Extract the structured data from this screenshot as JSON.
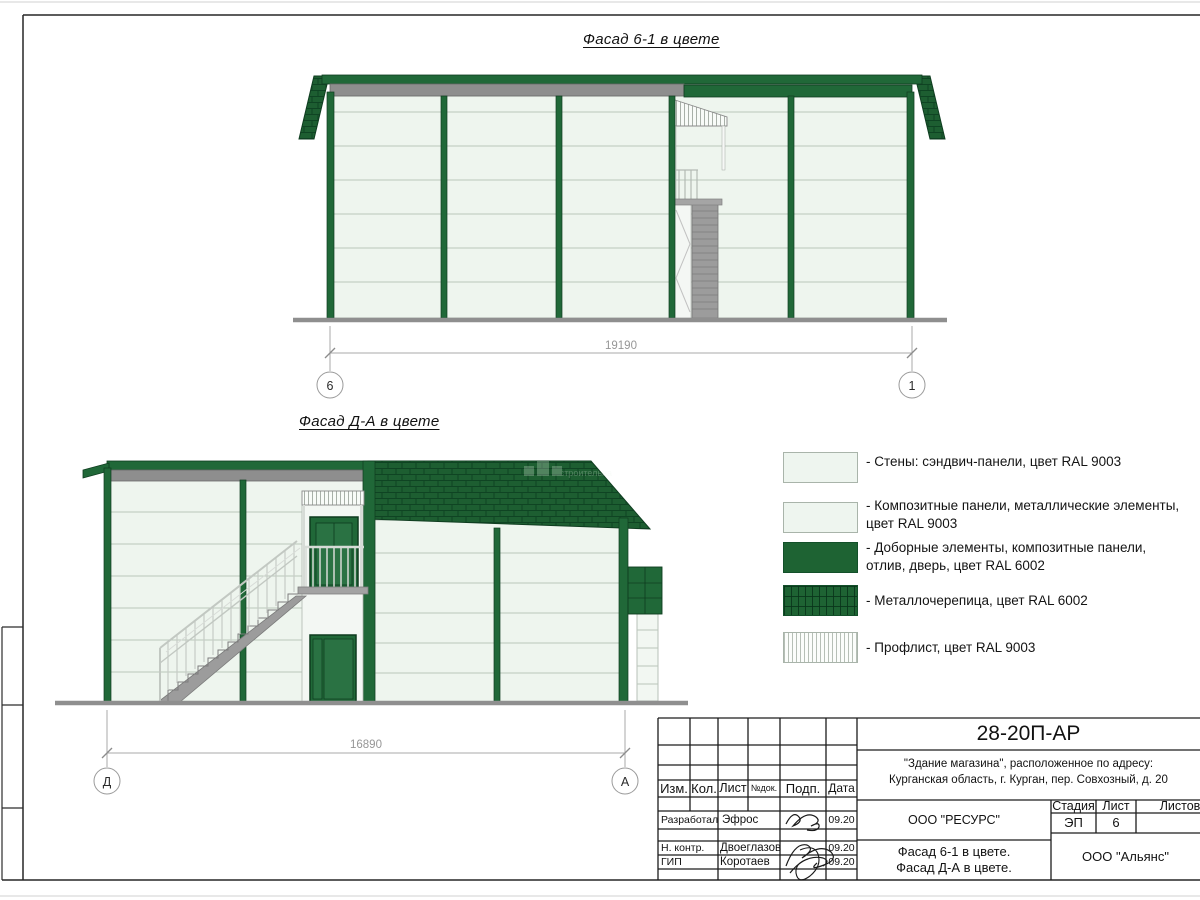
{
  "sheet": {
    "facade1": {
      "title": "Фасад 6-1 в цвете",
      "dimension": "19190",
      "axis_left": "6",
      "axis_right": "1"
    },
    "facade2": {
      "title": "Фасад Д-А в цвете",
      "dimension": "16890",
      "axis_left": "Д",
      "axis_right": "А",
      "watermark": "строительна"
    }
  },
  "legend": {
    "items": [
      {
        "swatch": "light",
        "lines": [
          "- Стены: сэндвич-панели, цвет RAL 9003",
          ""
        ]
      },
      {
        "swatch": "light",
        "lines": [
          "- Композитные панели, металлические элементы,",
          "цвет RAL 9003"
        ]
      },
      {
        "swatch": "solid-green",
        "lines": [
          "- Доборные элементы,  композитные панели,",
          "отлив, дверь, цвет RAL 6002"
        ]
      },
      {
        "swatch": "tile-green",
        "lines": [
          "- Металлочерепица, цвет RAL 6002",
          ""
        ]
      },
      {
        "swatch": "proflist",
        "lines": [
          "- Профлист, цвет RAL 9003",
          ""
        ]
      }
    ]
  },
  "tb": {
    "doc_number": "28-20П-АР",
    "address1": "\"Здание магазина\", расположенное по адресу:",
    "address2": "Курганская область, г. Курган, пер. Совхозный, д. 20",
    "cols": [
      "Изм.",
      "Кол.",
      "Лист",
      "№док.",
      "Подп.",
      "Дата"
    ],
    "rows": [
      {
        "role": "Разработал",
        "name": "Эфрос",
        "date": "09.20"
      },
      {
        "role": "Н. контр.",
        "name": "Двоеглазов",
        "date": "09.20"
      },
      {
        "role": "ГИП",
        "name": "Коротаев",
        "date": "09.20"
      }
    ],
    "org_design": "ООО \"РЕСУРС\"",
    "org_client": "ООО \"Альянс\"",
    "title1": "Фасад 6-1 в цвете.",
    "title2": "Фасад Д-А в цвете.",
    "stage_label": "Стадия",
    "sheet_label": "Лист",
    "sheets_label": "Листов",
    "stage": "ЭП",
    "sheet_no": "6"
  },
  "colors": {
    "frame_green": "#206838",
    "roof_green": "#1d5e31",
    "wall_light": "#eef5ee",
    "fascia_gray": "#8e8e8e",
    "stair_gray": "#9c9c9c",
    "dim_gray": "#969696"
  }
}
